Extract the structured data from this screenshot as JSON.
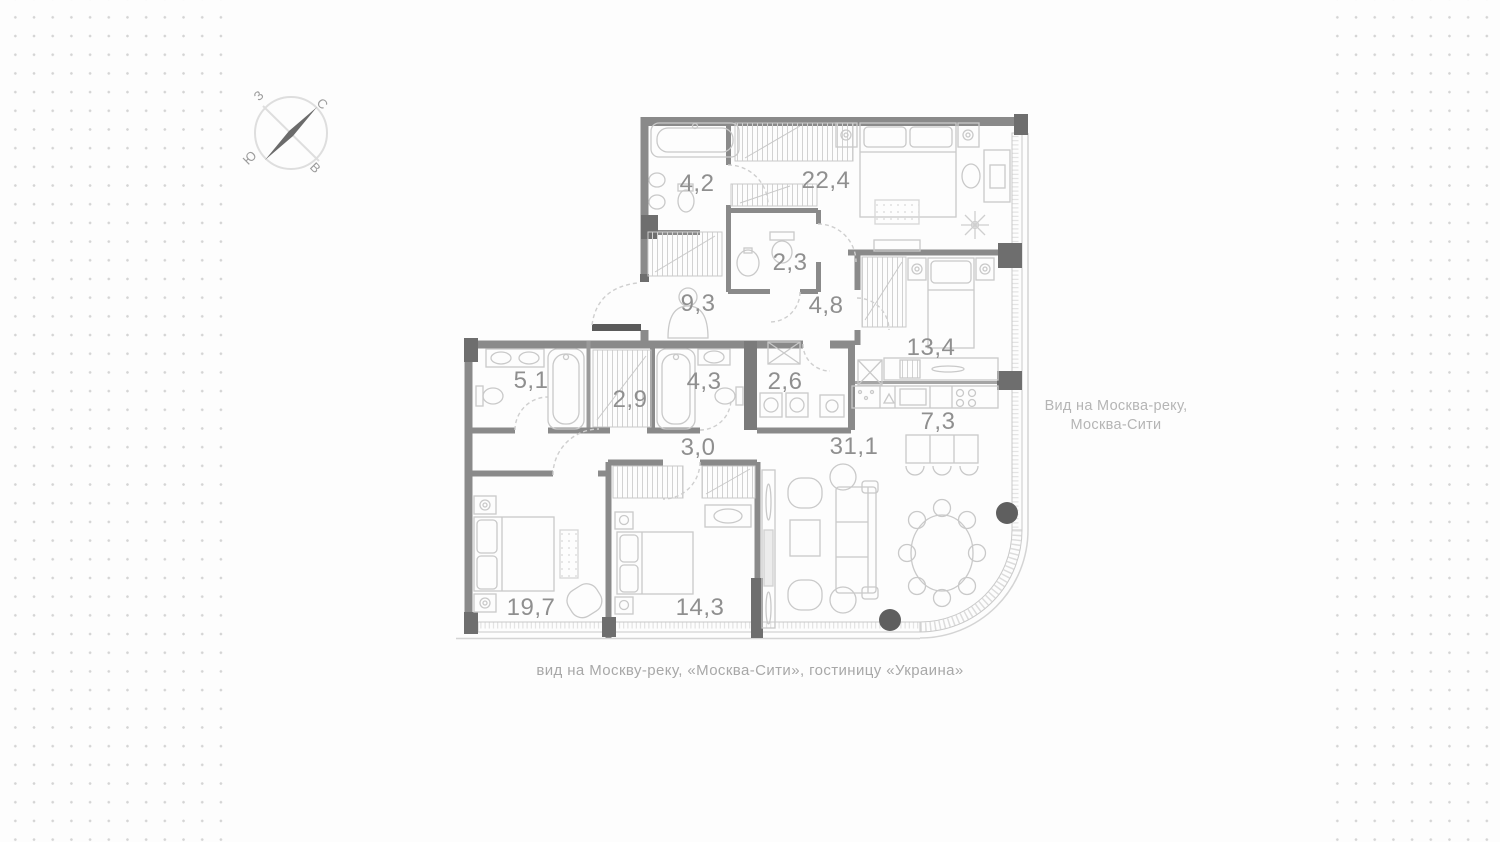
{
  "canvas": {
    "background": "#fdfdfd",
    "dot_color": "#d4d4d4"
  },
  "compass": {
    "west": "З",
    "north": "С",
    "south": "Ю",
    "east": "В"
  },
  "plan": {
    "wall_color": "#8a8a8a",
    "dark_accent": "#5f5f5f",
    "furniture_color": "#c9c9c9",
    "label_color": "#8f8f8f",
    "rooms": [
      {
        "id": "bathroom-1",
        "area": "4,2"
      },
      {
        "id": "master-bedroom",
        "area": "22,4"
      },
      {
        "id": "wc",
        "area": "2,3"
      },
      {
        "id": "entrance-hall",
        "area": "9,3"
      },
      {
        "id": "corridor",
        "area": "4,8"
      },
      {
        "id": "bedroom-child",
        "area": "13,4"
      },
      {
        "id": "bathroom-2",
        "area": "5,1"
      },
      {
        "id": "wardrobe",
        "area": "2,9"
      },
      {
        "id": "bathroom-3",
        "area": "4,3"
      },
      {
        "id": "laundry",
        "area": "2,6"
      },
      {
        "id": "kitchen",
        "area": "7,3"
      },
      {
        "id": "living-room",
        "area": "31,1"
      },
      {
        "id": "inner-corridor",
        "area": "3,0"
      },
      {
        "id": "bedroom-2",
        "area": "19,7"
      },
      {
        "id": "bedroom-3",
        "area": "14,3"
      }
    ]
  },
  "captions": {
    "right_view_line1": "Вид на Москва-реку,",
    "right_view_line2": "Москва-Сити",
    "bottom_view": "вид на Москву-реку, «Москва-Сити», гостиницу «Украина»"
  }
}
